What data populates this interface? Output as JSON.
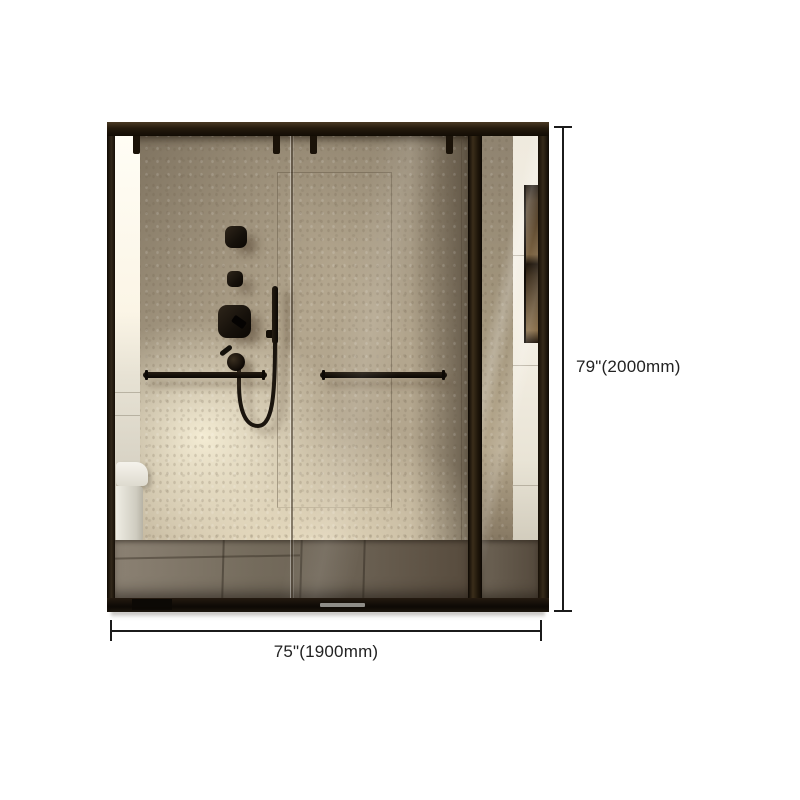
{
  "page": {
    "background": "#ffffff"
  },
  "product_image": {
    "alt": "Black framed glass sliding shower enclosure with beige stone wall, black shower fixtures, hand shower with hose, two towel bars, toilet at left, white tile wall with recessed niche at right",
    "frame_color": "#241a10",
    "wall_color": "#b3a68e",
    "sunlight_color": "#f6e9cb",
    "floor_color": "#6e6456"
  },
  "dimensions": {
    "height": {
      "label": "79\"(2000mm)"
    },
    "width": {
      "label": "75\"(1900mm)"
    },
    "line_color": "#1b1b1b",
    "text_color": "#222222"
  }
}
